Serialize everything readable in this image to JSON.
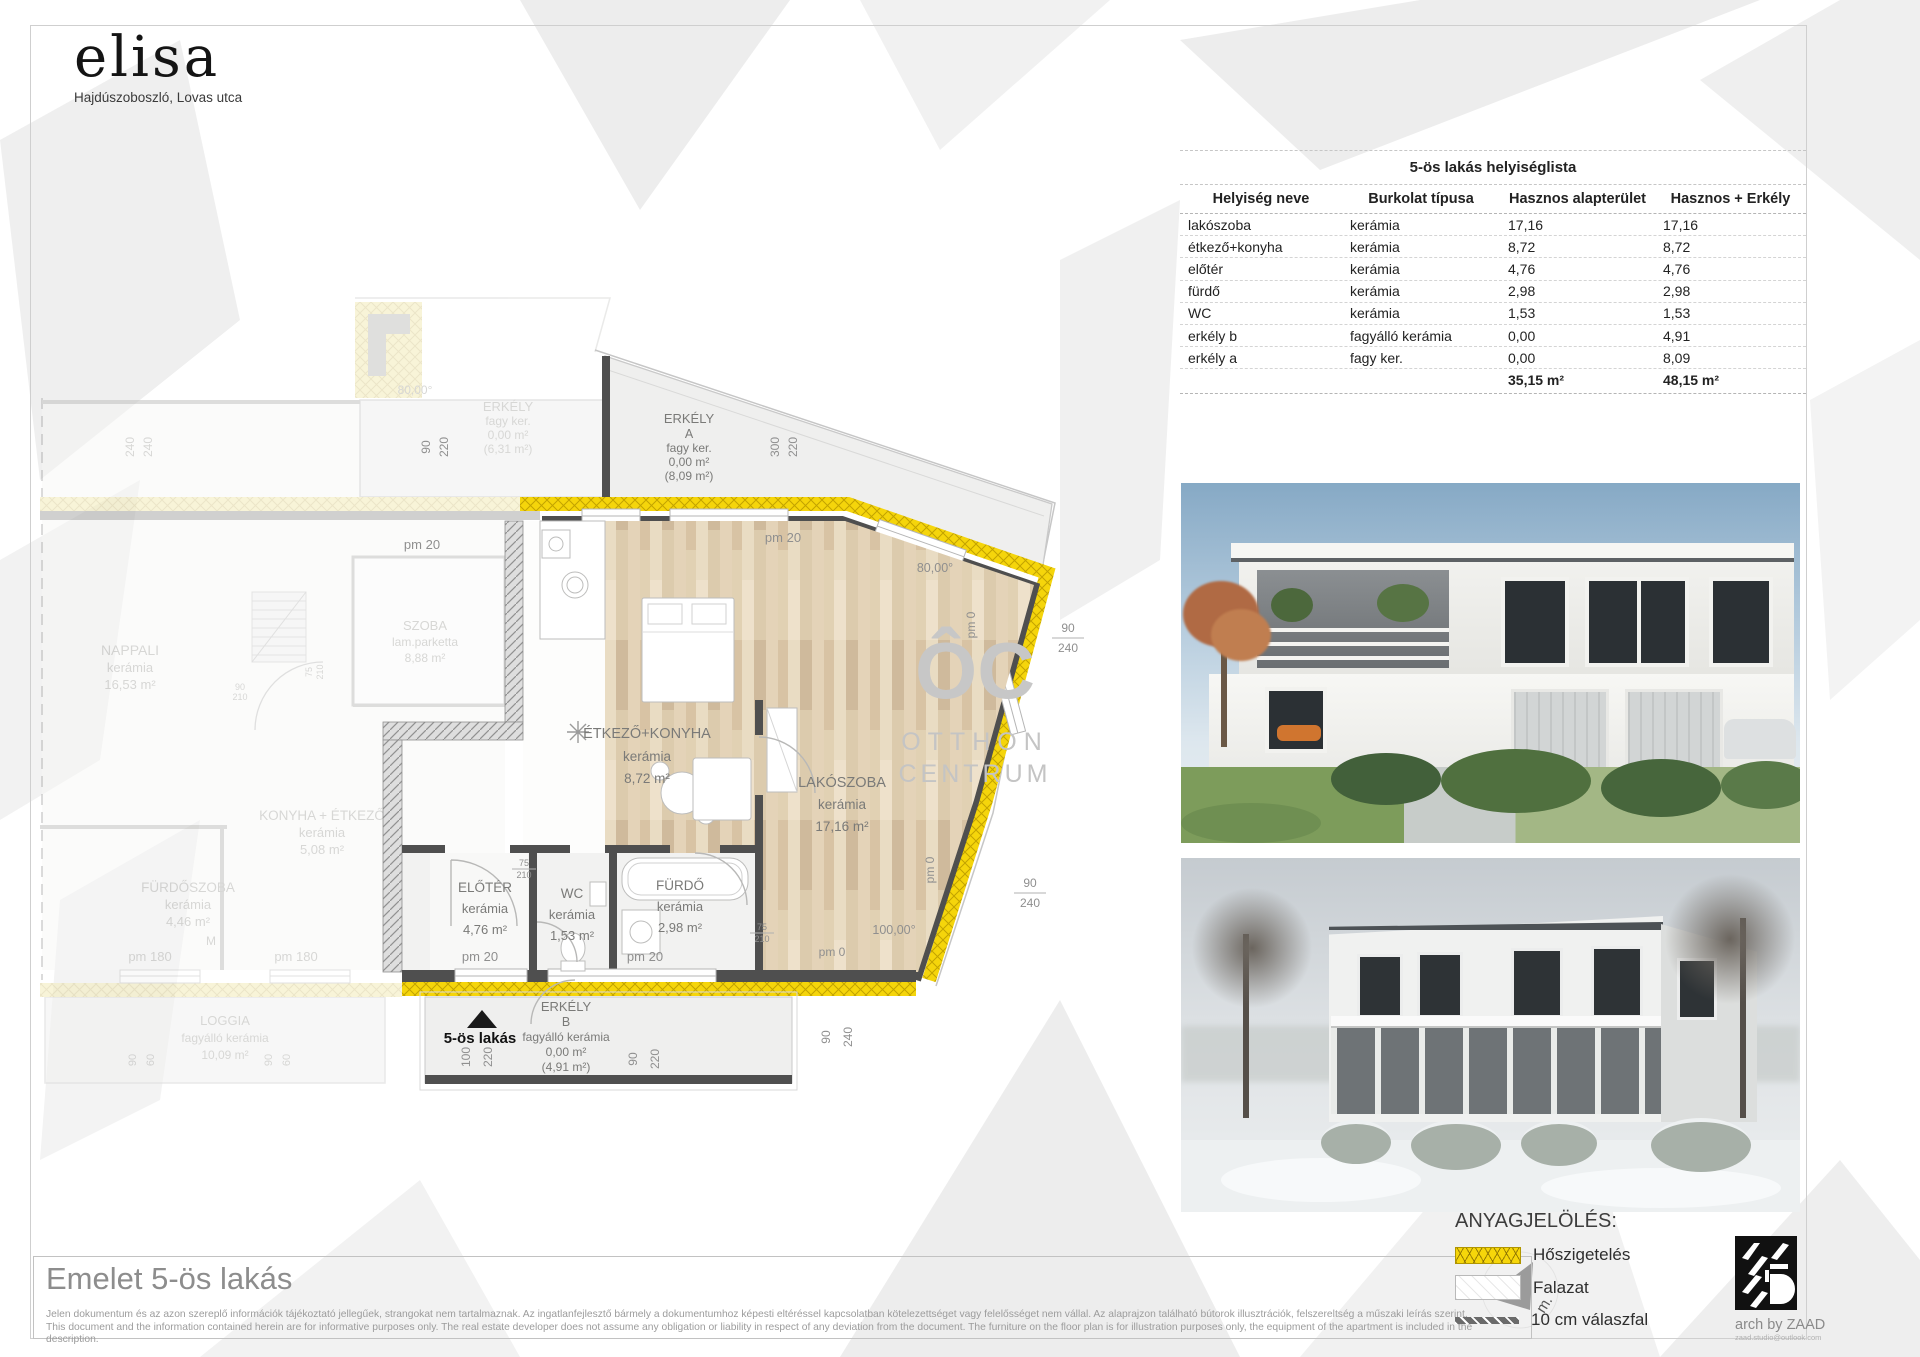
{
  "logo": {
    "brand": "elisa",
    "subtitle": "Hajdúszoboszló, Lovas utca"
  },
  "table": {
    "title": "5-ös lakás helyiséglista",
    "columns": [
      "Helyiség neve",
      "Burkolat típusa",
      "Hasznos alapterület",
      "Hasznos + Erkély"
    ],
    "rows": [
      [
        "lakószoba",
        "kerámia",
        "17,16",
        "17,16"
      ],
      [
        "étkező+konyha",
        "kerámia",
        "8,72",
        "8,72"
      ],
      [
        "előtér",
        "kerámia",
        "4,76",
        "4,76"
      ],
      [
        "fürdő",
        "kerámia",
        "2,98",
        "2,98"
      ],
      [
        "WC",
        "kerámia",
        "1,53",
        "1,53"
      ],
      [
        "erkély b",
        "fagyálló kerámia",
        "0,00",
        "4,91"
      ],
      [
        "erkély a",
        "fagy ker.",
        "0,00",
        "8,09"
      ]
    ],
    "totals": {
      "hasznos": "35,15 m²",
      "hasznos_erkely": "48,15 m²"
    }
  },
  "plan": {
    "unit_label": "5-ös lakás",
    "watermark": {
      "big": "ÔC",
      "line1": "OTTHON",
      "line2": "CENTRUM"
    },
    "rooms": {
      "erkely_a": {
        "l1": "ERKÉLY",
        "l2": "A",
        "l3": "fagy ker.",
        "l4": "0,00 m²",
        "l5": "(8,09 m²)"
      },
      "etkezo": {
        "l1": "ÉTKEZŐ+KONYHA",
        "l2": "kerámia",
        "l3": "8,72 m²"
      },
      "lakoszoba": {
        "l1": "LAKÓSZOBA",
        "l2": "kerámia",
        "l3": "17,16 m²"
      },
      "eloter": {
        "l1": "ELŐTÉR",
        "l2": "kerámia",
        "l3": "4,76 m²"
      },
      "wc": {
        "l1": "WC",
        "l2": "kerámia",
        "l3": "1,53 m²"
      },
      "furdo": {
        "l1": "FÜRDŐ",
        "l2": "kerámia",
        "l3": "2,98 m²"
      },
      "erkely_b": {
        "l1": "ERKÉLY",
        "l2": "B",
        "l3": "fagyálló kerámia",
        "l4": "0,00 m²",
        "l5": "(4,91 m²)"
      }
    },
    "neighbor": {
      "erkely": {
        "l1": "ERKÉLY",
        "l2": "fagy ker.",
        "l3": "0,00 m²",
        "l4": "(6,31 m²)"
      },
      "szoba": {
        "l1": "SZOBA",
        "l2": "lam.parketta",
        "l3": "8,88 m²"
      },
      "nappali": {
        "l1": "NAPPALI",
        "l2": "kerámia",
        "l3": "16,53 m²"
      },
      "konyha": {
        "l1": "KONYHA + ÉTKEZŐ",
        "l2": "kerámia",
        "l3": "5,08 m²"
      },
      "furdoszoba": {
        "l1": "FÜRDŐSZOBA",
        "l2": "kerámia",
        "l3": "4,46 m²"
      },
      "loggia": {
        "l1": "LOGGIA",
        "l2": "fagyálló kerámia",
        "l3": "10,09 m²"
      },
      "m": "M"
    },
    "dims": {
      "d240": "240",
      "d220": "220",
      "d300": "300",
      "d90": "90",
      "d100": "100",
      "d60": "60",
      "d75": "75",
      "d210": "210",
      "a80": "80,00°",
      "a100": "100,00°",
      "pm20": "pm 20",
      "pm0": "pm 0",
      "pm180": "pm 180"
    }
  },
  "footer": {
    "title": "Emelet 5-ös lakás",
    "disclaimer_hu": "Jelen dokumentum és az azon szereplő információk tájékoztató jellegűek, strangokat nem tartalmaznak. Az ingatlanfejlesztő bármely a dokumentumhoz képesti eltéréssel kapcsolatban kötelezettséget vagy felelősséget nem vállal. Az alaprajzon található bútorok illusztrációk, felszereltség a műszaki leírás szerint.",
    "disclaimer_en": "This document and the information contained herein are for informative purposes only. The real estate developer does not assume any obligation or liability in respect of any deviation from the document. The furniture on the floor plan is for illustration purposes only, the equipment of the apartment is included in the description."
  },
  "legend": {
    "title": "ANYAGJELÖLÉS:",
    "item1": "Hőszigetelés",
    "item2": "Falazat",
    "item3": "10 cm válaszfal",
    "north": "m."
  },
  "credit": {
    "name": "arch by ZAAD",
    "email": "zaad.studio@outlook.com"
  }
}
